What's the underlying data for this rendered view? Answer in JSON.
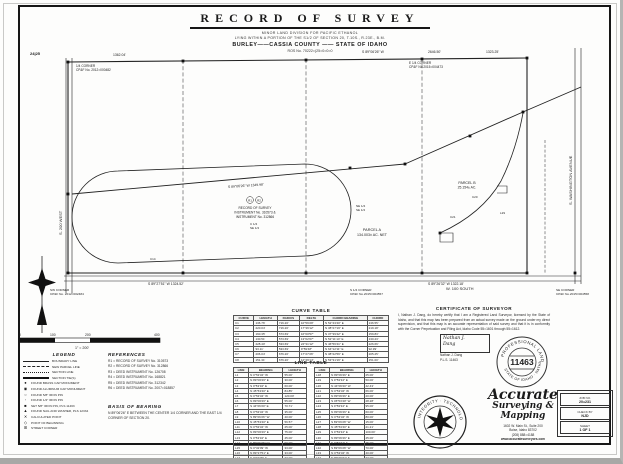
{
  "header": {
    "title": "RECORD OF SURVEY",
    "subtitle1": "MINOR LAND DIVISION FOR PACIFIC ETHANOL",
    "subtitle2": "LYING WITHIN A PORTION OF THE S1/2 OF SECTION 20, T.10S., R.23E., B.M.",
    "subtitle3": "BURLEY——CASSIA COUNTY —— STATE OF IDAHO",
    "subtitle4": "ROS No. 70222=(25=0=0=0"
  },
  "map": {
    "sec_corner_tl": "24|25",
    "w_quarter_1": "1/4 CORNER",
    "w_quarter_2": "CP&F No. 2012=000482",
    "dist_1362": "1362.04'",
    "bearing_top": "S 89°06'26\" W",
    "dist_2646": "2646.50'",
    "dist_1323": "1323.25'",
    "e_quarter_1": "E 1/4 CORNER",
    "e_quarter_2": "CP&F No.2015=004473",
    "road_west": "S. 200 WEST",
    "road_right": "S. WASHINGTON AVENUE",
    "road_south": "W. 100 SOUTH",
    "bearing_mid": "S 89°06'26\" W   1349.98'",
    "pob_r1": "R1",
    "pob_r2": "R2",
    "pob_line1": "RECORD OF SURVEY",
    "pob_line2": "INSTRUMENT No. 310573 &",
    "pob_line3": "INSTRUMENT No. 312866",
    "quarter_c": "C 1/4",
    "quarter_se": "SE 1/4",
    "q_ne": "NE 1/4",
    "q_se2": "SE 1/4",
    "parcel_a_name": "PARCEL A",
    "parcel_a_area": "134.003± AC. NET",
    "parcel_b_name": "PARCEL B",
    "parcel_b_area": "25.154± AC.",
    "bearing_bl": "S 89°27'51\" W   1324.52'",
    "bearing_br": "S 89°26'32\" W   1322.18'",
    "s_quarter_1": "S 1/4 CORNER",
    "s_quarter_2": "CP&F No.2015=004557",
    "sw_corner_1": "SW CORNER",
    "sw_corner_2": "CP&F No. 2012=002484",
    "se_corner_1": "SE CORNER",
    "se_corner_2": "CP&F No.2015=004558",
    "c20": "C20",
    "c21": "C21",
    "l29": "L29",
    "c14": "C14"
  },
  "scale_bar": {
    "t0": "0",
    "t100": "100",
    "t200": "200",
    "t400": "400",
    "note": "1\" = 200'"
  },
  "legend": {
    "title": "LEGEND",
    "lines": [
      {
        "label": "BOUNDARY LINE"
      },
      {
        "label": "NEW PARCEL LINE"
      },
      {
        "label": "SECTION LINE"
      },
      {
        "label": "SECTION TIE(S)"
      }
    ],
    "points": [
      {
        "glyph": "●",
        "label": "FOUND BRASS CAP MONUMENT"
      },
      {
        "glyph": "◉",
        "label": "FOUND ALUMINUM CAP MONUMENT"
      },
      {
        "glyph": "○",
        "label": "FOUND 5/8\" IRON PIN"
      },
      {
        "glyph": "◦",
        "label": "FOUND 1/2\" IRON PIN"
      },
      {
        "glyph": "■",
        "label": "SET 5/8\" IRON PIN, PLS 11463"
      },
      {
        "glyph": "▲",
        "label": "FOUND NAIL AND WASHER, PLS 12334"
      },
      {
        "glyph": "✕",
        "label": "CALCULATED POINT"
      },
      {
        "glyph": "◇",
        "label": "POINT OF BEGINNING"
      },
      {
        "glyph": "⊞",
        "label": "STREET CORNER"
      }
    ]
  },
  "references": {
    "title": "REFERENCES",
    "items": [
      "R1 = RECORD OF SURVEY No. 310573",
      "R2 = RECORD OF SURVEY No. 312866",
      "R3 = DEED INSTRUMENT No. 126708",
      "R4 = DEED INSTRUMENT No. 168821",
      "R5 = DEED INSTRUMENT No. 312342",
      "R6 = DEED INSTRUMENT No. 2007=018857"
    ]
  },
  "basis_of_bearing": {
    "title": "BASIS OF BEARING",
    "text": "N 89°06'26\" E BETWEEN THE CENTER 1/4 CORNER AND THE EAST 1/4 CORNER OF SECTION 20."
  },
  "curve_table": {
    "title": "CURVE TABLE",
    "header_rows": [
      [
        "CURVE",
        "LENGTH",
        "RADIUS",
        "DELTA",
        "CHORD BEARING",
        "CHORD"
      ]
    ],
    "rows": [
      [
        "C1",
        "136.76'",
        "716.20'",
        "10°56'29\"",
        "N 52°43'40\" E",
        "136.55'"
      ],
      [
        "C2",
        "220.04'",
        "716.20'",
        "17°36'12\"",
        "N 38°27'19\" E",
        "219.18'"
      ],
      [
        "C3",
        "160.35'",
        "573.69'",
        "16°00'57\"",
        "N 37°39'42\" E",
        "159.83'"
      ],
      [
        "C4",
        "130.51'",
        "573.69'",
        "13°02'07\"",
        "N 52°11'14\" E",
        "130.23'"
      ],
      [
        "C5",
        "228.40'",
        "533.69'",
        "24°31'12\"",
        "N 46°56'41\" E",
        "226.66'"
      ],
      [
        "C6",
        "93.11'",
        "533.69'",
        "9°59'48\"",
        "N 64°12'11\" E",
        "92.99'"
      ],
      [
        "C7",
        "206.04'",
        "676.20'",
        "17°27'26\"",
        "N 38°22'56\" E",
        "205.25'"
      ],
      [
        "C8",
        "151.31'",
        "676.20'",
        "12°49'14\"",
        "N 53°31'16\" E",
        "151.00'"
      ]
    ]
  },
  "line_table": {
    "title": "LINE TABLE",
    "header_rows": [
      [
        "LINE",
        "BEARING",
        "LENGTH"
      ]
    ],
    "left_rows": [
      [
        "L1",
        "N 0°53'34\" W",
        "55.00'"
      ],
      [
        "L2",
        "N 89°06'26\" E",
        "30.00'"
      ],
      [
        "L3",
        "S 0°53'34\" E",
        "60.00'"
      ],
      [
        "L4",
        "N 45°53'40\" E",
        "84.85'"
      ],
      [
        "L5",
        "N 0°53'34\" W",
        "120.00'"
      ],
      [
        "L6",
        "N 89°06'26\" E",
        "55.00'"
      ],
      [
        "L7",
        "S 44°06'20\" E",
        "70.71'"
      ],
      [
        "L8",
        "N 0°53'34\" W",
        "35.00'"
      ],
      [
        "L9",
        "S 89°06'26\" W",
        "40.00'"
      ],
      [
        "L10",
        "N 45°53'40\" E",
        "56.57'"
      ],
      [
        "L11",
        "N 0°53'34\" W",
        "25.00'"
      ],
      [
        "L12",
        "N 89°06'26\" E",
        "75.00'"
      ],
      [
        "L13",
        "S 0°53'34\" E",
        "45.00'"
      ],
      [
        "L14",
        "S 89°06'26\" W",
        "90.00'"
      ],
      [
        "L15",
        "N 0°32'09\" W",
        "33.00'"
      ],
      [
        "L16",
        "N 89°27'51\" E",
        "33.00'"
      ],
      [
        "L17",
        "S 0°32'09\" E",
        "33.00'"
      ]
    ],
    "right_rows": [
      [
        "L18",
        "N 89°06'26\" E",
        "25.00'"
      ],
      [
        "L19",
        "S 0°53'34\" E",
        "50.00'"
      ],
      [
        "L20",
        "N 44°06'20\" W",
        "42.43'"
      ],
      [
        "L21",
        "N 0°53'34\" W",
        "66.00'"
      ],
      [
        "L22",
        "N 89°06'26\" E",
        "20.00'"
      ],
      [
        "L23",
        "S 45°53'40\" W",
        "28.28'"
      ],
      [
        "L24",
        "S 0°53'34\" E",
        "95.00'"
      ],
      [
        "L25",
        "N 89°06'26\" E",
        "60.00'"
      ],
      [
        "L26",
        "N 0°53'34\" W",
        "80.00'"
      ],
      [
        "L27",
        "S 89°06'26\" W",
        "15.00'"
      ],
      [
        "L28",
        "N 45°53'40\" E",
        "21.21'"
      ],
      [
        "L29",
        "S 0°53'34\" E",
        "100.00'"
      ],
      [
        "L30",
        "N 89°06'26\" E",
        "45.00'"
      ],
      [
        "L31",
        "S 0°53'34\" E",
        "35.00'"
      ],
      [
        "L32",
        "S 89°06'26\" W",
        "70.00'"
      ],
      [
        "L33",
        "N 0°53'34\" W",
        "40.00'"
      ],
      [
        "L34",
        "N 89°26'32\" E",
        "33.00'"
      ]
    ]
  },
  "certificate": {
    "title": "CERTIFICATE OF SURVEYOR",
    "body": "I, Nathan J. Dang, do hereby certify that I am a Registered Land Surveyor, licensed by the State of Idaho, and that this map has been prepared from an actual survey made on the ground under my direct supervision, and that this map is an accurate representation of said survey and that it is in conformity with the Corner Perpetuation and Filing Act, Idaho Code 55=1601 through 55=1612.",
    "sig_line1": "Nathan J.",
    "sig_line2": "Dang",
    "name": "Nathan J. Dang",
    "pls": "P.L.S. 11463"
  },
  "stamp": {
    "arc_top": "PROFESSIONAL LAND SURVEYOR",
    "number": "11463",
    "arc_bottom": "STATE OF IDAHO · NATHAN J. DANG"
  },
  "firm": {
    "name1": "Accurate",
    "name2": "Surveying &",
    "name3": "Mapping",
    "address1": "1602 W. Main St., Suite 200",
    "address2": "Boise, Idaho  83702",
    "phone": "(208) 888=4188",
    "web": "www.accuratesurveyors.com",
    "seal_arc": "INTEGRITY · TECHNOLOGY · ACCURACY"
  },
  "job_block": {
    "job_label": "JOB NO.",
    "job_no": "20=231",
    "check_label": "CHECK BY",
    "check_by": "NJD",
    "sheet_label": "SHEET",
    "sheet": "1 OF 1"
  }
}
